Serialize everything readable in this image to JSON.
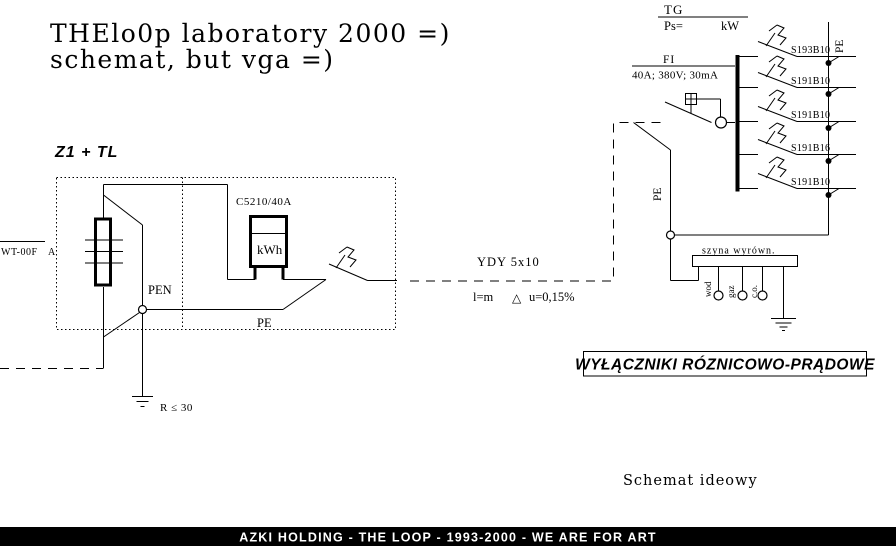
{
  "colors": {
    "ink": "#000000",
    "paper": "#ffffff",
    "footer_bg": "#000000",
    "footer_text": "#ffffff"
  },
  "title": {
    "line1": "THElo0p laboratory 2000 =)",
    "line2": "schemat, but vga =)"
  },
  "left_panel": {
    "name": "Z1 + TL",
    "incoming_fuse": {
      "label": "WT-00F",
      "phase_mark": "A"
    },
    "meter": {
      "model": "C5210/40A",
      "unit": "kWh"
    },
    "pen_label": "PEN",
    "pe_label": "PE",
    "earthing_note": "R ≤ 30"
  },
  "cable": {
    "type": "YDY 5x10",
    "length": "l=m",
    "delta_symbol": "△",
    "voltage_drop": "u=0,15%"
  },
  "switchgear": {
    "tg": {
      "name": "TG",
      "power_label": "Ps=",
      "power_unit": "kW"
    },
    "fi": {
      "name": "FI",
      "rating": "40A; 380V; 30mA"
    },
    "pe_riser_label": "PE",
    "pe_bus_label": "PE",
    "breakers": [
      {
        "label": "S193B10"
      },
      {
        "label": "S191B10"
      },
      {
        "label": "S191B10"
      },
      {
        "label": "S191B16"
      },
      {
        "label": "S191B10"
      }
    ],
    "equipotential_bus": {
      "label": "szyna wyrówn.",
      "taps": [
        {
          "label": "wod"
        },
        {
          "label": "gaz"
        },
        {
          "label": "c.o."
        }
      ]
    }
  },
  "notes": {
    "rcd_box": "WYŁĄCZNIKI RÓZNICOWO-PRĄDOWE",
    "caption": "Schemat ideowy"
  },
  "footer": {
    "text": "AZKI HOLDING - THE LOOP - 1993-2000 - WE ARE FOR ART"
  }
}
